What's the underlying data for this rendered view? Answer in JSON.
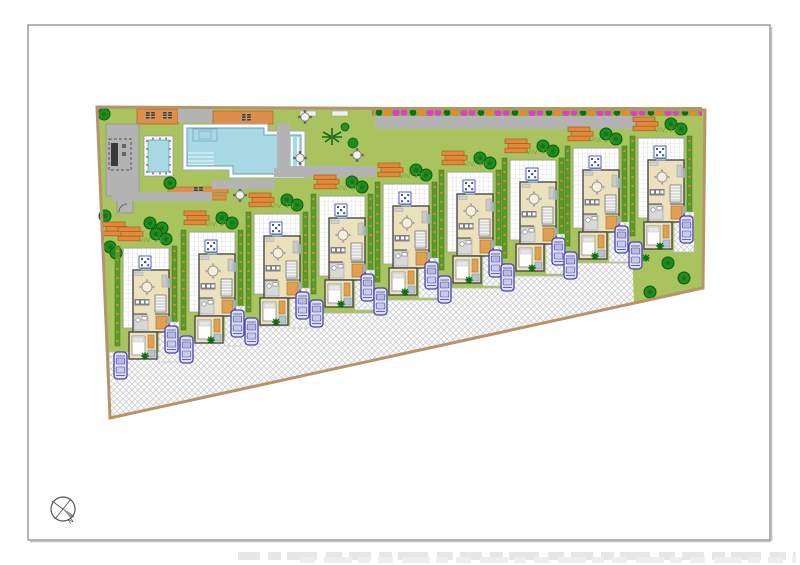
{
  "site_plan": {
    "title_note": "",
    "villas": [
      {
        "label": "VIV. 21"
      },
      {
        "label": "VIV. 20"
      },
      {
        "label": "VIV. 19"
      },
      {
        "label": "VIV. 18"
      },
      {
        "label": "VIV. 17"
      },
      {
        "label": "VIV. 16"
      },
      {
        "label": "VIV. 15"
      },
      {
        "label": "VIV. 14"
      },
      {
        "label": "VIV. 13"
      }
    ],
    "compass": {
      "north_label": "N"
    },
    "legend_colors": {
      "lawn": "#a9c45e",
      "pool_water": "#a8d8e4",
      "pool_border": "#ffffff",
      "path_gray": "#b3b3b3",
      "deck_orange": "#dd8f4a",
      "hedge_green": "#5a9a2c",
      "tree_green": "#1e8c1e",
      "flower_magenta": "#df3fc8",
      "flower_orange": "#ef8a1a",
      "boundary_tan": "#b5946c",
      "house_beige": "#ebe2bd",
      "car_blue": "#4646a8",
      "paving_white": "#f7f7f7"
    }
  }
}
